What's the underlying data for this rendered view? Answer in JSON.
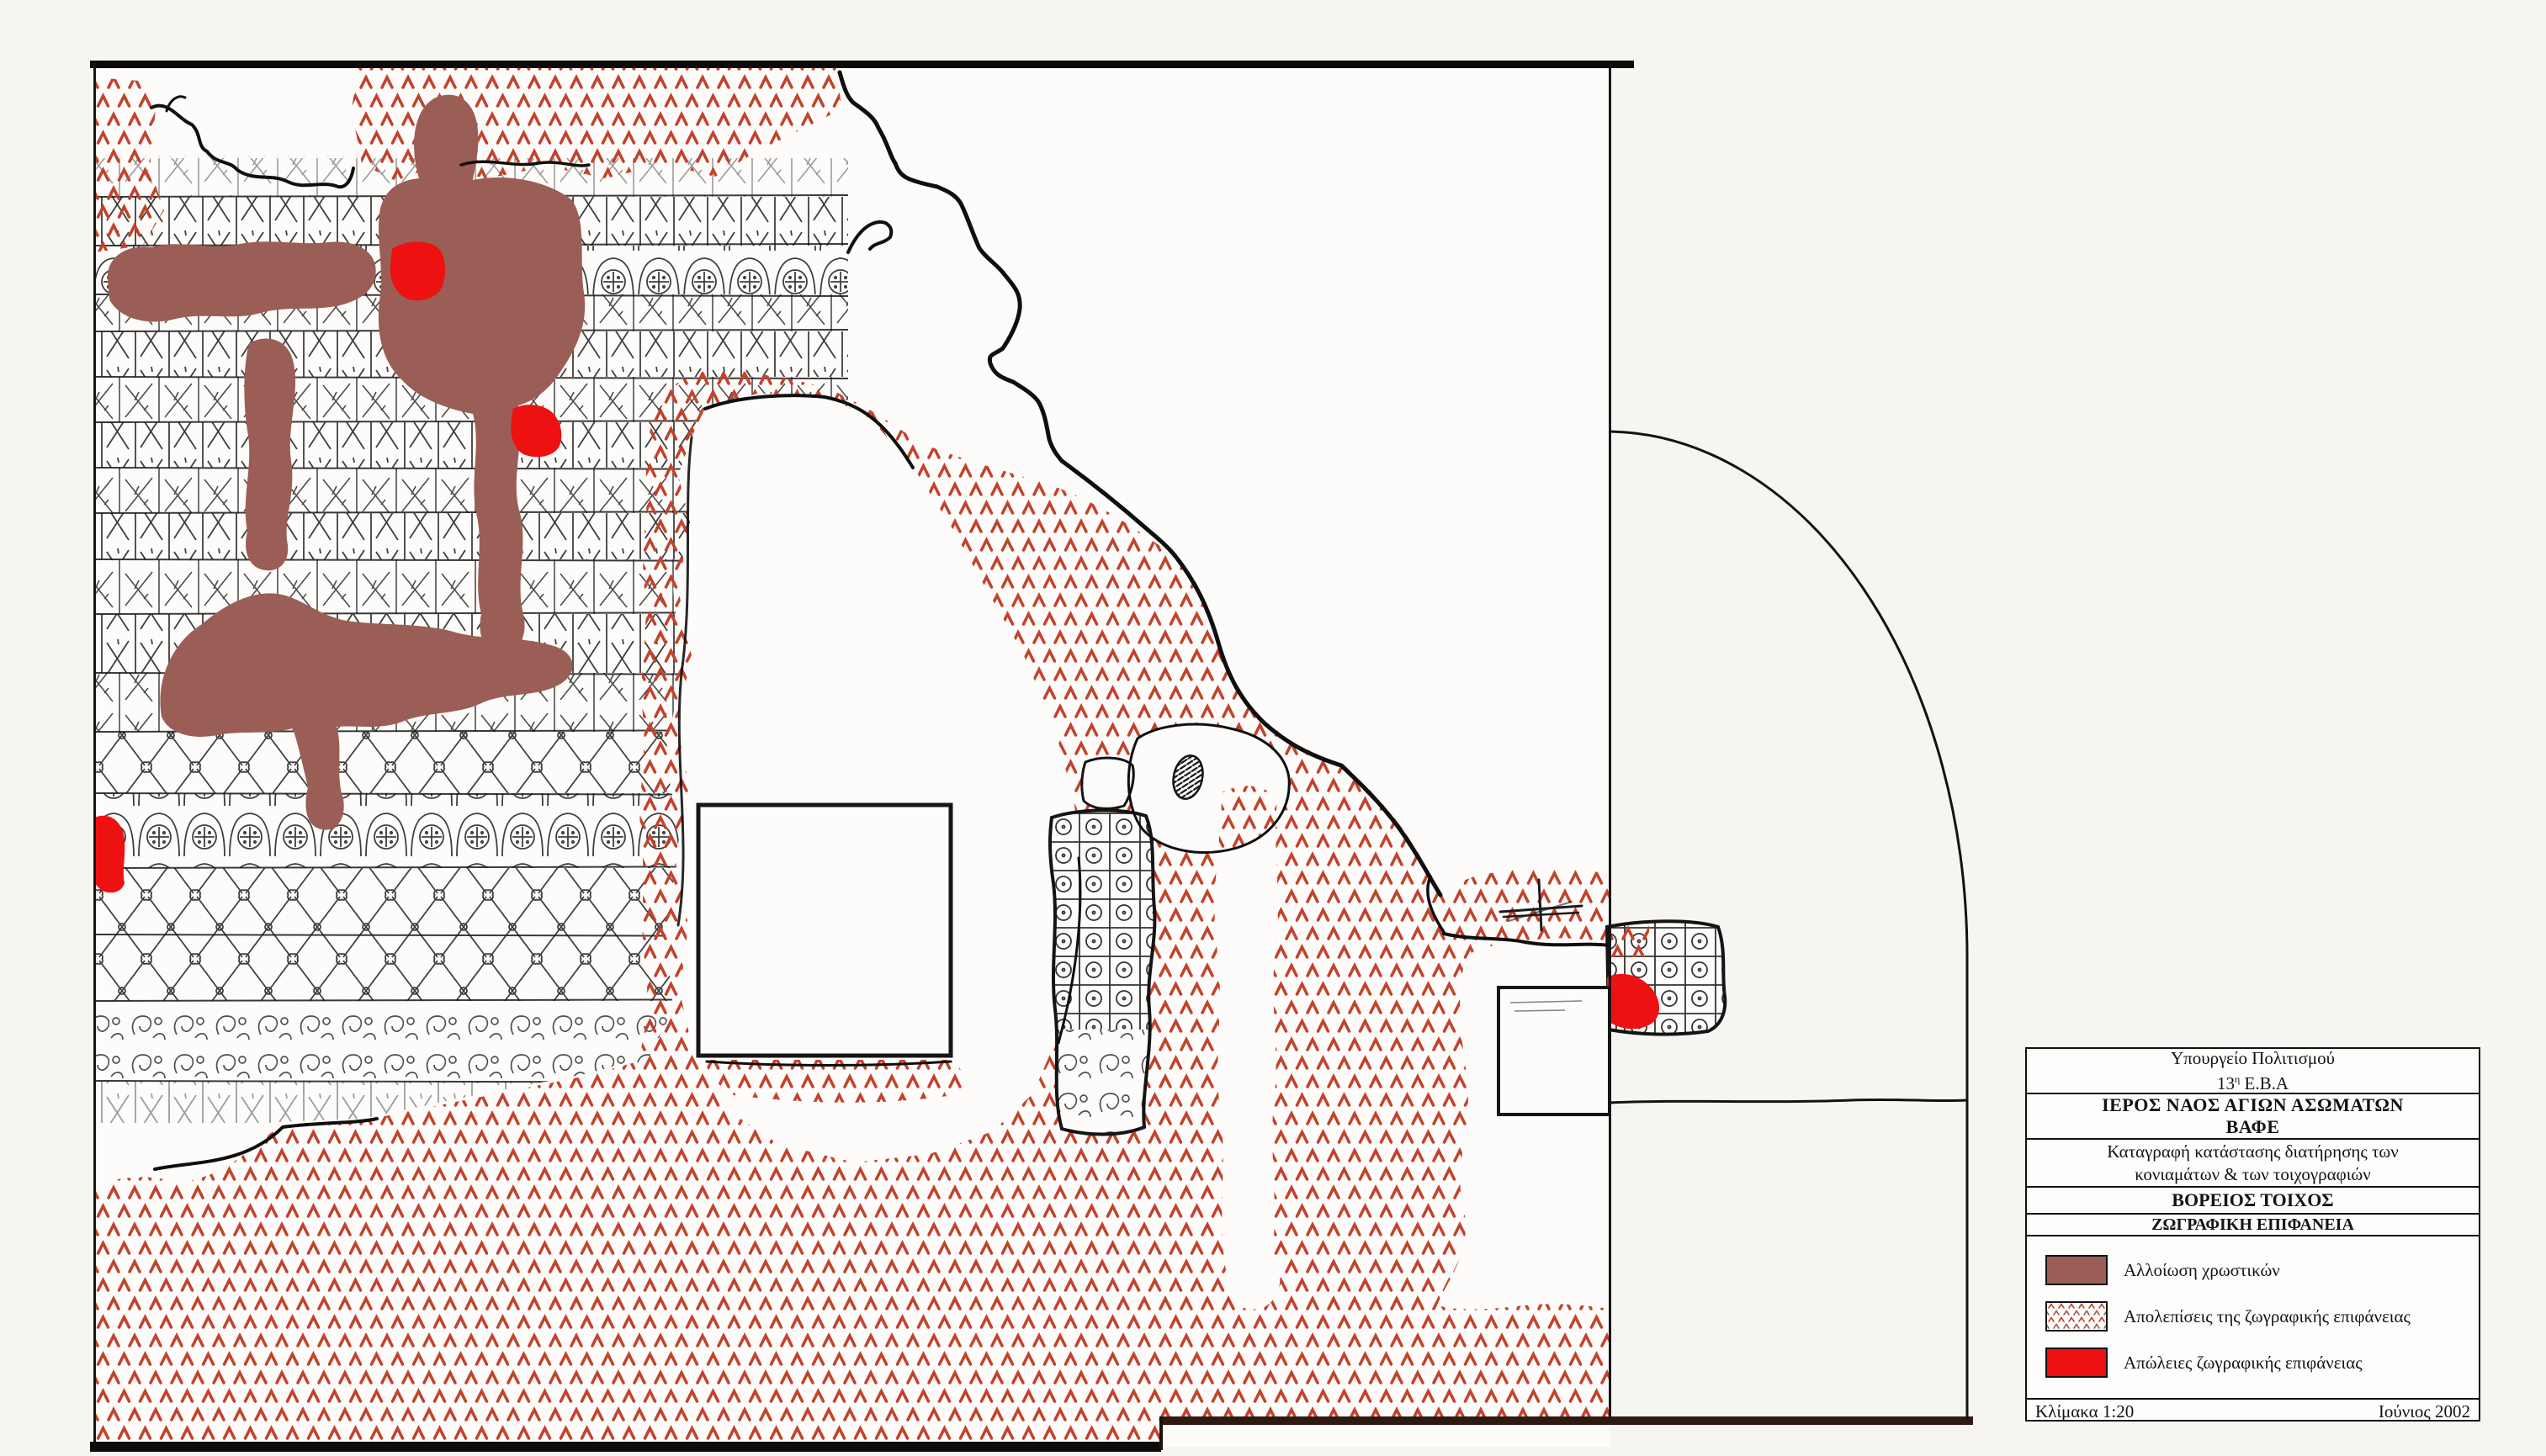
{
  "title_block": {
    "ministry_line1": "Υπουργείο Πολιτισμού",
    "eba_num": "13",
    "eba_sup": "η",
    "eba_rest": " Ε.Β.Α",
    "church_name": "ΙΕΡΟΣ ΝΑΟΣ ΑΓΙΩΝ ΑΣΩΜΑΤΩΝ",
    "location": "ΒΑΦΕ",
    "survey_line1": "Καταγραφή κατάστασης διατήρησης των",
    "survey_line2": "κονιαμάτων & των τοιχογραφιών",
    "wall_title": "ΒΟΡΕΙΟΣ ΤΟΙΧΟΣ",
    "surface_title": "ΖΩΓΡΑΦΙΚΗ ΕΠΙΦΑΝΕΙΑ",
    "scale_label": "Κλίμακα 1:20",
    "date_label": "Ιούνιος  2002"
  },
  "legend": {
    "entries": [
      {
        "label": "Αλλοίωση χρωστικών",
        "swatch": "solid-maroon"
      },
      {
        "label": "Απολεπίσεις της ζωγραφικής επιφάνειας",
        "swatch": "chevron-pattern"
      },
      {
        "label": "Απώλειες ζωγραφικής επιφάνειας",
        "swatch": "solid-red"
      }
    ]
  },
  "colors": {
    "alteration": "#9a5e56",
    "loss": "#ee1111",
    "flaking": "#c2432c",
    "ink": "#141414"
  },
  "drawing": {
    "hatch_glyph": "Λ",
    "subject": "north-wall-painted-surface-condition-map"
  }
}
